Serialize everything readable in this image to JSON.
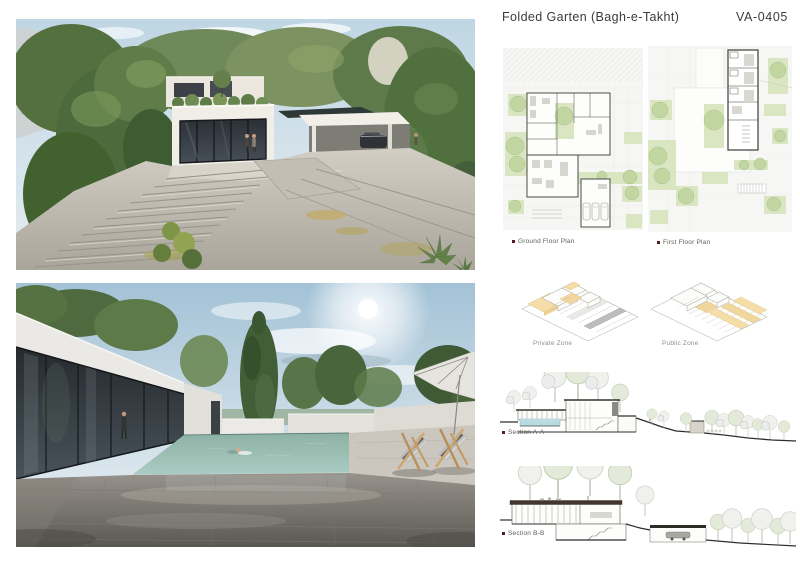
{
  "header": {
    "title": "Folded Garten (Bagh-e-Takht)",
    "code": "VA-0405"
  },
  "panels": {
    "ground_floor": {
      "label": "Ground Floor Plan"
    },
    "first_floor": {
      "label": "First Floor Plan"
    },
    "private_zone": {
      "label": "Private Zone"
    },
    "public_zone": {
      "label": "Public Zone"
    },
    "section_aa": {
      "label": "Section A-A"
    },
    "section_bb": {
      "label": "Section B-B"
    }
  },
  "colors": {
    "board_background": "#ffffff",
    "title_text": "#3b3b39",
    "caption_text": "#5c5c5a",
    "zone_caption_text": "#8e8e8c",
    "caption_bullet": "#571c1c",
    "zone_highlight_orange": "#f4dda6",
    "plan_vegetation_green": "#d9e6c1",
    "section_pool_blue": "#b7dbe0",
    "render_pool_teal": "#9cc0b5",
    "drawing_line": "#3c3c38"
  }
}
